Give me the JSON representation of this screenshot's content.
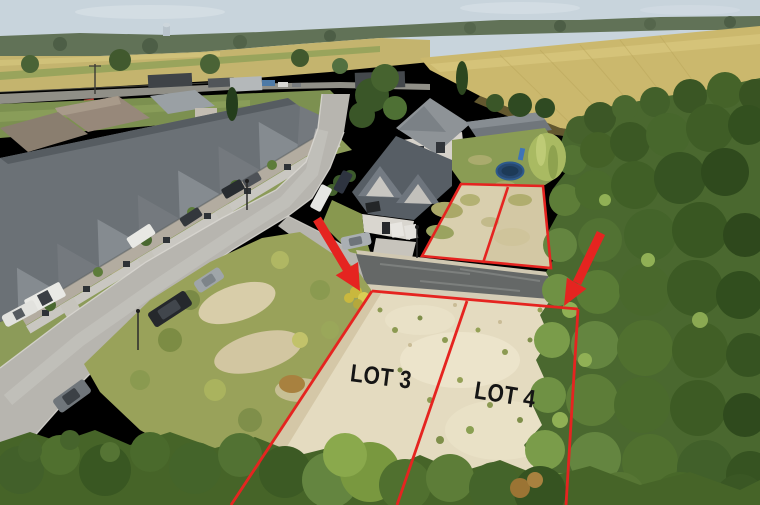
{
  "image": {
    "type": "aerial-real-estate-photo",
    "lot_labels": [
      {
        "id": "lot3",
        "text": "LOT 3"
      },
      {
        "id": "lot4",
        "text": "LOT 4"
      }
    ]
  },
  "colors": {
    "annotation-red": "#e52420",
    "label-black": "#151515",
    "sky": "#c8d4dc",
    "horizon-green": "#617257",
    "field-gold": "#cbb86d",
    "sand-lot": "#e4dbc0",
    "sand-upper": "#d9cfae",
    "concrete-street": "#b7b5af",
    "sidewalk": "#c9c7c1",
    "asphalt-lane": "#656867",
    "roof-gray": "#6b7176",
    "foliage-dark": "#3a5626",
    "foliage-mid": "#577634",
    "foliage-light": "#7fa24a",
    "scrub-green": "#99a25a",
    "trampoline-blue": "#27486f"
  }
}
